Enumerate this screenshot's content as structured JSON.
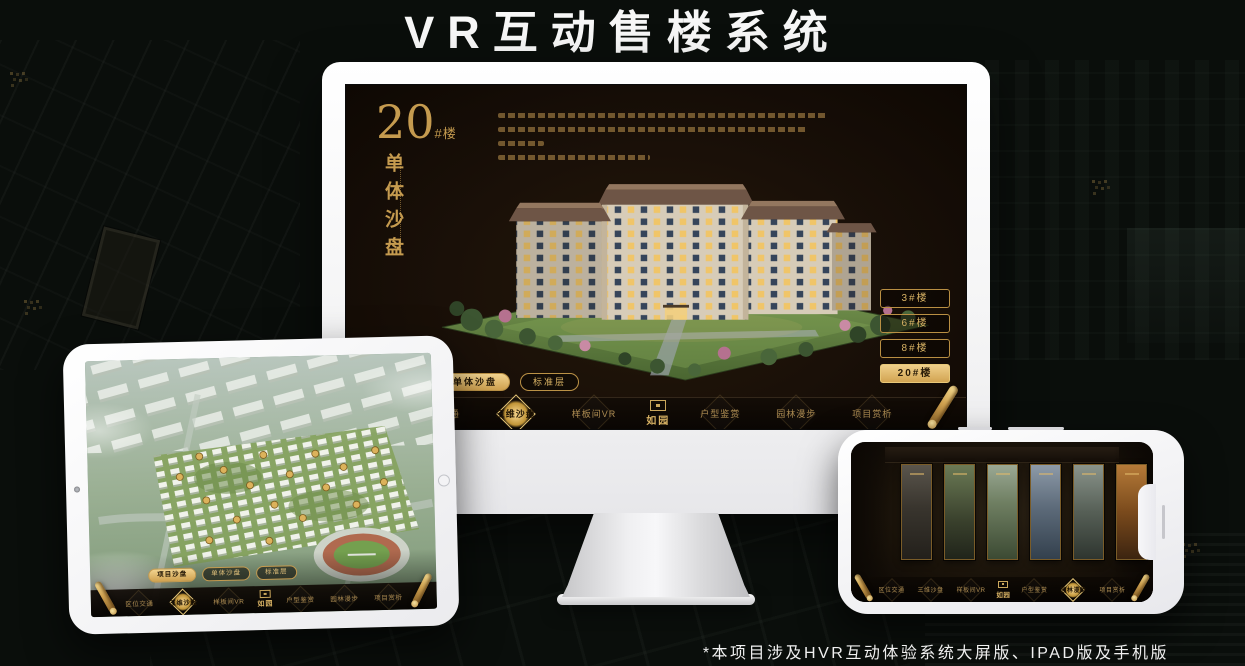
{
  "page": {
    "title": "VR互动售楼系统",
    "footnote": "*本项目涉及HVR互动体验系统大屏版、IPAD版及手机版"
  },
  "colors": {
    "gold": "#d8b264",
    "gold_active": "#e8c878",
    "background": "#0a0e0b",
    "screen_bg": "#1a1008"
  },
  "monitor": {
    "headline": {
      "number": "20",
      "unit": "#楼",
      "subtitle": "单体沙盘"
    },
    "floor_buttons": [
      {
        "label": "3#楼",
        "active": false
      },
      {
        "label": "6#楼",
        "active": false
      },
      {
        "label": "8#楼",
        "active": false
      },
      {
        "label": "20#楼",
        "active": true
      }
    ],
    "tabs": [
      {
        "label": "项目沙盘",
        "active": false
      },
      {
        "label": "单体沙盘",
        "active": true
      },
      {
        "label": "标准层",
        "active": false
      }
    ],
    "nav": {
      "logo": "如园",
      "items": [
        {
          "label": "区位交通",
          "active": false
        },
        {
          "label": "三维沙盘",
          "active": true
        },
        {
          "label": "样板间VR",
          "active": false
        },
        {
          "label": "户型鉴赏",
          "active": false
        },
        {
          "label": "园林漫步",
          "active": false
        },
        {
          "label": "项目赏析",
          "active": false
        }
      ]
    }
  },
  "tablet": {
    "tabs": [
      {
        "label": "项目沙盘",
        "active": true
      },
      {
        "label": "单体沙盘",
        "active": false
      },
      {
        "label": "标准层",
        "active": false
      }
    ],
    "nav": {
      "logo": "如园",
      "items": [
        {
          "label": "区位交通",
          "active": false
        },
        {
          "label": "三维沙盘",
          "active": true
        },
        {
          "label": "样板间VR",
          "active": false
        },
        {
          "label": "户型鉴赏",
          "active": false
        },
        {
          "label": "园林漫步",
          "active": false
        },
        {
          "label": "项目赏析",
          "active": false
        }
      ]
    }
  },
  "phone": {
    "nav": {
      "logo": "如园",
      "items": [
        {
          "label": "区位交通",
          "active": false
        },
        {
          "label": "三维沙盘",
          "active": false
        },
        {
          "label": "样板间VR",
          "active": false
        },
        {
          "label": "户型鉴赏",
          "active": false
        },
        {
          "label": "园林漫步",
          "active": true
        },
        {
          "label": "项目赏析",
          "active": false
        }
      ]
    }
  }
}
